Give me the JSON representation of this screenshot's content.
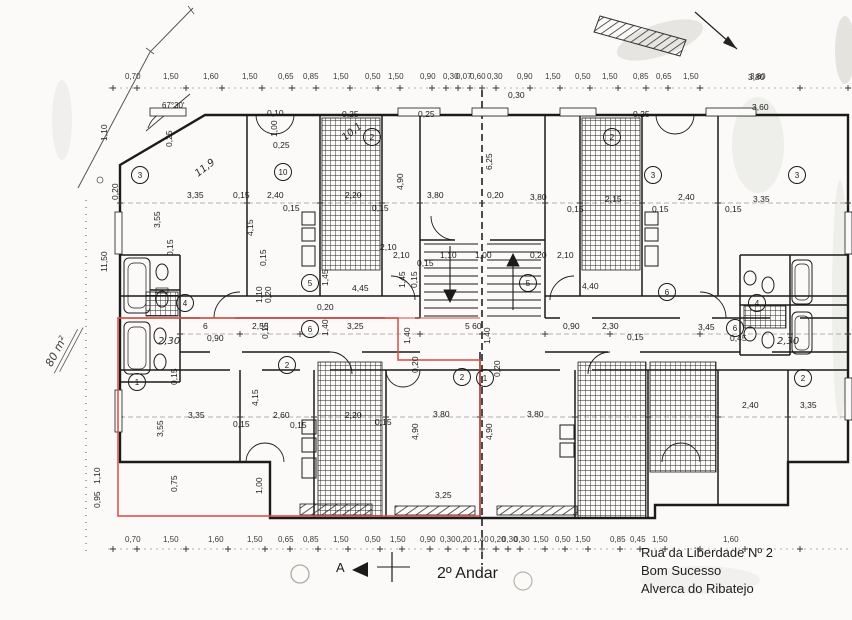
{
  "meta": {
    "floor_label": "2º Andar",
    "section_marker": "A",
    "area_annotation": "80 m²",
    "angle_annotation": "67°30'"
  },
  "address": {
    "line1": "Rua da Liberdade Nº 2",
    "line2": "Bom Sucesso",
    "line3": "Alverca do Ribatejo"
  },
  "colors": {
    "ink": "#1c1c1c",
    "highlight_red": "#d8504a",
    "paper": "#fbfaf8"
  },
  "dimension_labels": {
    "top_row": [
      {
        "x": 125,
        "t": "0,70"
      },
      {
        "x": 163,
        "t": "1,50"
      },
      {
        "x": 203,
        "t": "1,60"
      },
      {
        "x": 242,
        "t": "1,50"
      },
      {
        "x": 278,
        "t": "0,65"
      },
      {
        "x": 303,
        "t": "0,85"
      },
      {
        "x": 333,
        "t": "1,50"
      },
      {
        "x": 365,
        "t": "0,50"
      },
      {
        "x": 388,
        "t": "1,50"
      },
      {
        "x": 420,
        "t": "0,90"
      },
      {
        "x": 443,
        "t": "0,30"
      },
      {
        "x": 456,
        "t": "0,07"
      },
      {
        "x": 470,
        "t": "0,60"
      },
      {
        "x": 487,
        "t": "0,30"
      },
      {
        "x": 517,
        "t": "0,90"
      },
      {
        "x": 545,
        "t": "1,50"
      },
      {
        "x": 575,
        "t": "0,50"
      },
      {
        "x": 602,
        "t": "1,50"
      },
      {
        "x": 633,
        "t": "0,85"
      },
      {
        "x": 656,
        "t": "0,65"
      },
      {
        "x": 683,
        "t": "1,50"
      },
      {
        "x": 750,
        "t": "3,80"
      }
    ],
    "bottom_row": [
      {
        "x": 125,
        "t": "0,70"
      },
      {
        "x": 163,
        "t": "1,50"
      },
      {
        "x": 208,
        "t": "1,60"
      },
      {
        "x": 247,
        "t": "1,50"
      },
      {
        "x": 278,
        "t": "0,65"
      },
      {
        "x": 303,
        "t": "0,85"
      },
      {
        "x": 333,
        "t": "1,50"
      },
      {
        "x": 365,
        "t": "0,50"
      },
      {
        "x": 390,
        "t": "1,50"
      },
      {
        "x": 420,
        "t": "0,90"
      },
      {
        "x": 440,
        "t": "0,30"
      },
      {
        "x": 456,
        "t": "0,20"
      },
      {
        "x": 473,
        "t": "1,40"
      },
      {
        "x": 490,
        "t": "0,20"
      },
      {
        "x": 502,
        "t": "0,30"
      },
      {
        "x": 514,
        "t": "0,30"
      },
      {
        "x": 533,
        "t": "1,50"
      },
      {
        "x": 555,
        "t": "0,50"
      },
      {
        "x": 575,
        "t": "1,50"
      },
      {
        "x": 610,
        "t": "0,85"
      },
      {
        "x": 630,
        "t": "0,45"
      },
      {
        "x": 652,
        "t": "1,50"
      },
      {
        "x": 723,
        "t": "1,60"
      }
    ],
    "interior": [
      {
        "x": 187,
        "y": 198,
        "t": "3,35"
      },
      {
        "x": 233,
        "y": 198,
        "t": "0,15"
      },
      {
        "x": 267,
        "y": 198,
        "t": "2,40"
      },
      {
        "x": 283,
        "y": 211,
        "t": "0,15"
      },
      {
        "x": 345,
        "y": 198,
        "t": "2,20"
      },
      {
        "x": 372,
        "y": 211,
        "t": "0,15"
      },
      {
        "x": 427,
        "y": 198,
        "t": "3,80"
      },
      {
        "x": 487,
        "y": 198,
        "t": "0,20"
      },
      {
        "x": 530,
        "y": 200,
        "t": "3,80"
      },
      {
        "x": 567,
        "y": 212,
        "t": "0,15"
      },
      {
        "x": 605,
        "y": 202,
        "t": "2,15"
      },
      {
        "x": 652,
        "y": 212,
        "t": "0,15"
      },
      {
        "x": 678,
        "y": 200,
        "t": "2,40"
      },
      {
        "x": 725,
        "y": 212,
        "t": "0,15"
      },
      {
        "x": 753,
        "y": 202,
        "t": "3,35"
      },
      {
        "x": 160,
        "y": 228,
        "t": "3,55",
        "r": -90
      },
      {
        "x": 173,
        "y": 256,
        "t": "0,15",
        "r": -90
      },
      {
        "x": 253,
        "y": 236,
        "t": "4,15",
        "r": -90
      },
      {
        "x": 266,
        "y": 266,
        "t": "0,15",
        "r": -90
      },
      {
        "x": 403,
        "y": 190,
        "t": "4,90",
        "r": -90
      },
      {
        "x": 492,
        "y": 170,
        "t": "6,25",
        "r": -90
      },
      {
        "x": 262,
        "y": 303,
        "t": "1,10",
        "r": -90
      },
      {
        "x": 271,
        "y": 303,
        "t": "0,20",
        "r": -90
      },
      {
        "x": 328,
        "y": 286,
        "t": "1,45",
        "r": -90
      },
      {
        "x": 352,
        "y": 291,
        "t": "4,45"
      },
      {
        "x": 380,
        "y": 250,
        "t": "2,10"
      },
      {
        "x": 393,
        "y": 258,
        "t": "2,10"
      },
      {
        "x": 440,
        "y": 258,
        "t": "1,10"
      },
      {
        "x": 475,
        "y": 258,
        "t": "1,00"
      },
      {
        "x": 530,
        "y": 258,
        "t": "0,20"
      },
      {
        "x": 557,
        "y": 258,
        "t": "2,10"
      },
      {
        "x": 417,
        "y": 266,
        "t": "0,15"
      },
      {
        "x": 405,
        "y": 288,
        "t": "1,45",
        "r": -90
      },
      {
        "x": 417,
        "y": 288,
        "t": "0,15",
        "r": -90
      },
      {
        "x": 582,
        "y": 289,
        "t": "4,40"
      },
      {
        "x": 465,
        "y": 329,
        "t": "5 60"
      },
      {
        "x": 563,
        "y": 329,
        "t": "0,90"
      },
      {
        "x": 410,
        "y": 344,
        "t": "1,40",
        "r": -90
      },
      {
        "x": 490,
        "y": 344,
        "t": "1,40",
        "r": -90
      },
      {
        "x": 418,
        "y": 373,
        "t": "0,20",
        "r": -90
      },
      {
        "x": 500,
        "y": 377,
        "t": "0,20",
        "r": -90
      },
      {
        "x": 203,
        "y": 329,
        "t": "6"
      },
      {
        "x": 252,
        "y": 329,
        "t": "2,55"
      },
      {
        "x": 347,
        "y": 329,
        "t": "3,25"
      },
      {
        "x": 207,
        "y": 341,
        "t": "0,90"
      },
      {
        "x": 317,
        "y": 310,
        "t": "0,20"
      },
      {
        "x": 328,
        "y": 336,
        "t": "1,40",
        "r": -90
      },
      {
        "x": 268,
        "y": 339,
        "t": "0,15",
        "r": -90
      },
      {
        "x": 602,
        "y": 329,
        "t": "2,30"
      },
      {
        "x": 698,
        "y": 330,
        "t": "3,45"
      },
      {
        "x": 730,
        "y": 341,
        "t": "0,45"
      },
      {
        "x": 627,
        "y": 340,
        "t": "0,15"
      },
      {
        "x": 163,
        "y": 437,
        "t": "3,55",
        "r": -90
      },
      {
        "x": 188,
        "y": 418,
        "t": "3,35"
      },
      {
        "x": 233,
        "y": 427,
        "t": "0,15"
      },
      {
        "x": 258,
        "y": 406,
        "t": "4,15",
        "r": -90
      },
      {
        "x": 273,
        "y": 418,
        "t": "2,60"
      },
      {
        "x": 290,
        "y": 428,
        "t": "0,15"
      },
      {
        "x": 345,
        "y": 418,
        "t": "2,20"
      },
      {
        "x": 177,
        "y": 492,
        "t": "0,75",
        "r": -90
      },
      {
        "x": 262,
        "y": 494,
        "t": "1,00",
        "r": -90
      },
      {
        "x": 177,
        "y": 385,
        "t": "0,15",
        "r": -90
      },
      {
        "x": 433,
        "y": 417,
        "t": "3,80"
      },
      {
        "x": 527,
        "y": 417,
        "t": "3,80"
      },
      {
        "x": 375,
        "y": 425,
        "t": "0,15"
      },
      {
        "x": 418,
        "y": 440,
        "t": "4,90",
        "r": -90
      },
      {
        "x": 492,
        "y": 440,
        "t": "4,90",
        "r": -90
      },
      {
        "x": 435,
        "y": 498,
        "t": "3,25"
      },
      {
        "x": 742,
        "y": 408,
        "t": "2,40"
      },
      {
        "x": 800,
        "y": 408,
        "t": "3,35"
      },
      {
        "x": 748,
        "y": 80,
        "t": "3,80"
      },
      {
        "x": 752,
        "y": 110,
        "t": "3,60"
      },
      {
        "x": 508,
        "y": 98,
        "t": "0,30"
      },
      {
        "x": 267,
        "y": 116,
        "t": "0,10"
      },
      {
        "x": 277,
        "y": 137,
        "t": "1,00",
        "r": -90
      },
      {
        "x": 172,
        "y": 147,
        "t": "0,25",
        "r": -90
      },
      {
        "x": 273,
        "y": 148,
        "t": "0,25"
      },
      {
        "x": 342,
        "y": 117,
        "t": "0,25"
      },
      {
        "x": 418,
        "y": 117,
        "t": "0,25"
      },
      {
        "x": 633,
        "y": 117,
        "t": "0,25"
      },
      {
        "x": 107,
        "y": 141,
        "t": "1,10",
        "r": -90
      },
      {
        "x": 107,
        "y": 272,
        "t": "11,50",
        "r": -90
      },
      {
        "x": 100,
        "y": 484,
        "t": "1,10",
        "r": -90
      },
      {
        "x": 100,
        "y": 508,
        "t": "0,95",
        "r": -90
      },
      {
        "x": 118,
        "y": 200,
        "t": "0,20",
        "r": -90
      }
    ]
  },
  "handwritten_labels": [
    {
      "x": 198,
      "y": 177,
      "t": "11,9",
      "r": -38
    },
    {
      "x": 345,
      "y": 141,
      "t": "10,1",
      "r": -38
    },
    {
      "x": 158,
      "y": 344,
      "t": "2,30",
      "r": 0
    },
    {
      "x": 777,
      "y": 344,
      "t": "2,30",
      "r": 0
    }
  ],
  "room_tags": [
    {
      "x": 140,
      "y": 175,
      "t": "3"
    },
    {
      "x": 283,
      "y": 172,
      "t": "10"
    },
    {
      "x": 372,
      "y": 137,
      "t": "2"
    },
    {
      "x": 612,
      "y": 137,
      "t": "2"
    },
    {
      "x": 653,
      "y": 175,
      "t": "3"
    },
    {
      "x": 797,
      "y": 175,
      "t": "3"
    },
    {
      "x": 310,
      "y": 283,
      "t": "5"
    },
    {
      "x": 528,
      "y": 283,
      "t": "5"
    },
    {
      "x": 310,
      "y": 329,
      "t": "6"
    },
    {
      "x": 667,
      "y": 292,
      "t": "6"
    },
    {
      "x": 735,
      "y": 328,
      "t": "6"
    },
    {
      "x": 137,
      "y": 382,
      "t": "1"
    },
    {
      "x": 287,
      "y": 365,
      "t": "2"
    },
    {
      "x": 462,
      "y": 377,
      "t": "2"
    },
    {
      "x": 485,
      "y": 378,
      "t": "1"
    },
    {
      "x": 185,
      "y": 303,
      "t": "4"
    },
    {
      "x": 757,
      "y": 303,
      "t": "4"
    },
    {
      "x": 803,
      "y": 378,
      "t": "2"
    }
  ]
}
